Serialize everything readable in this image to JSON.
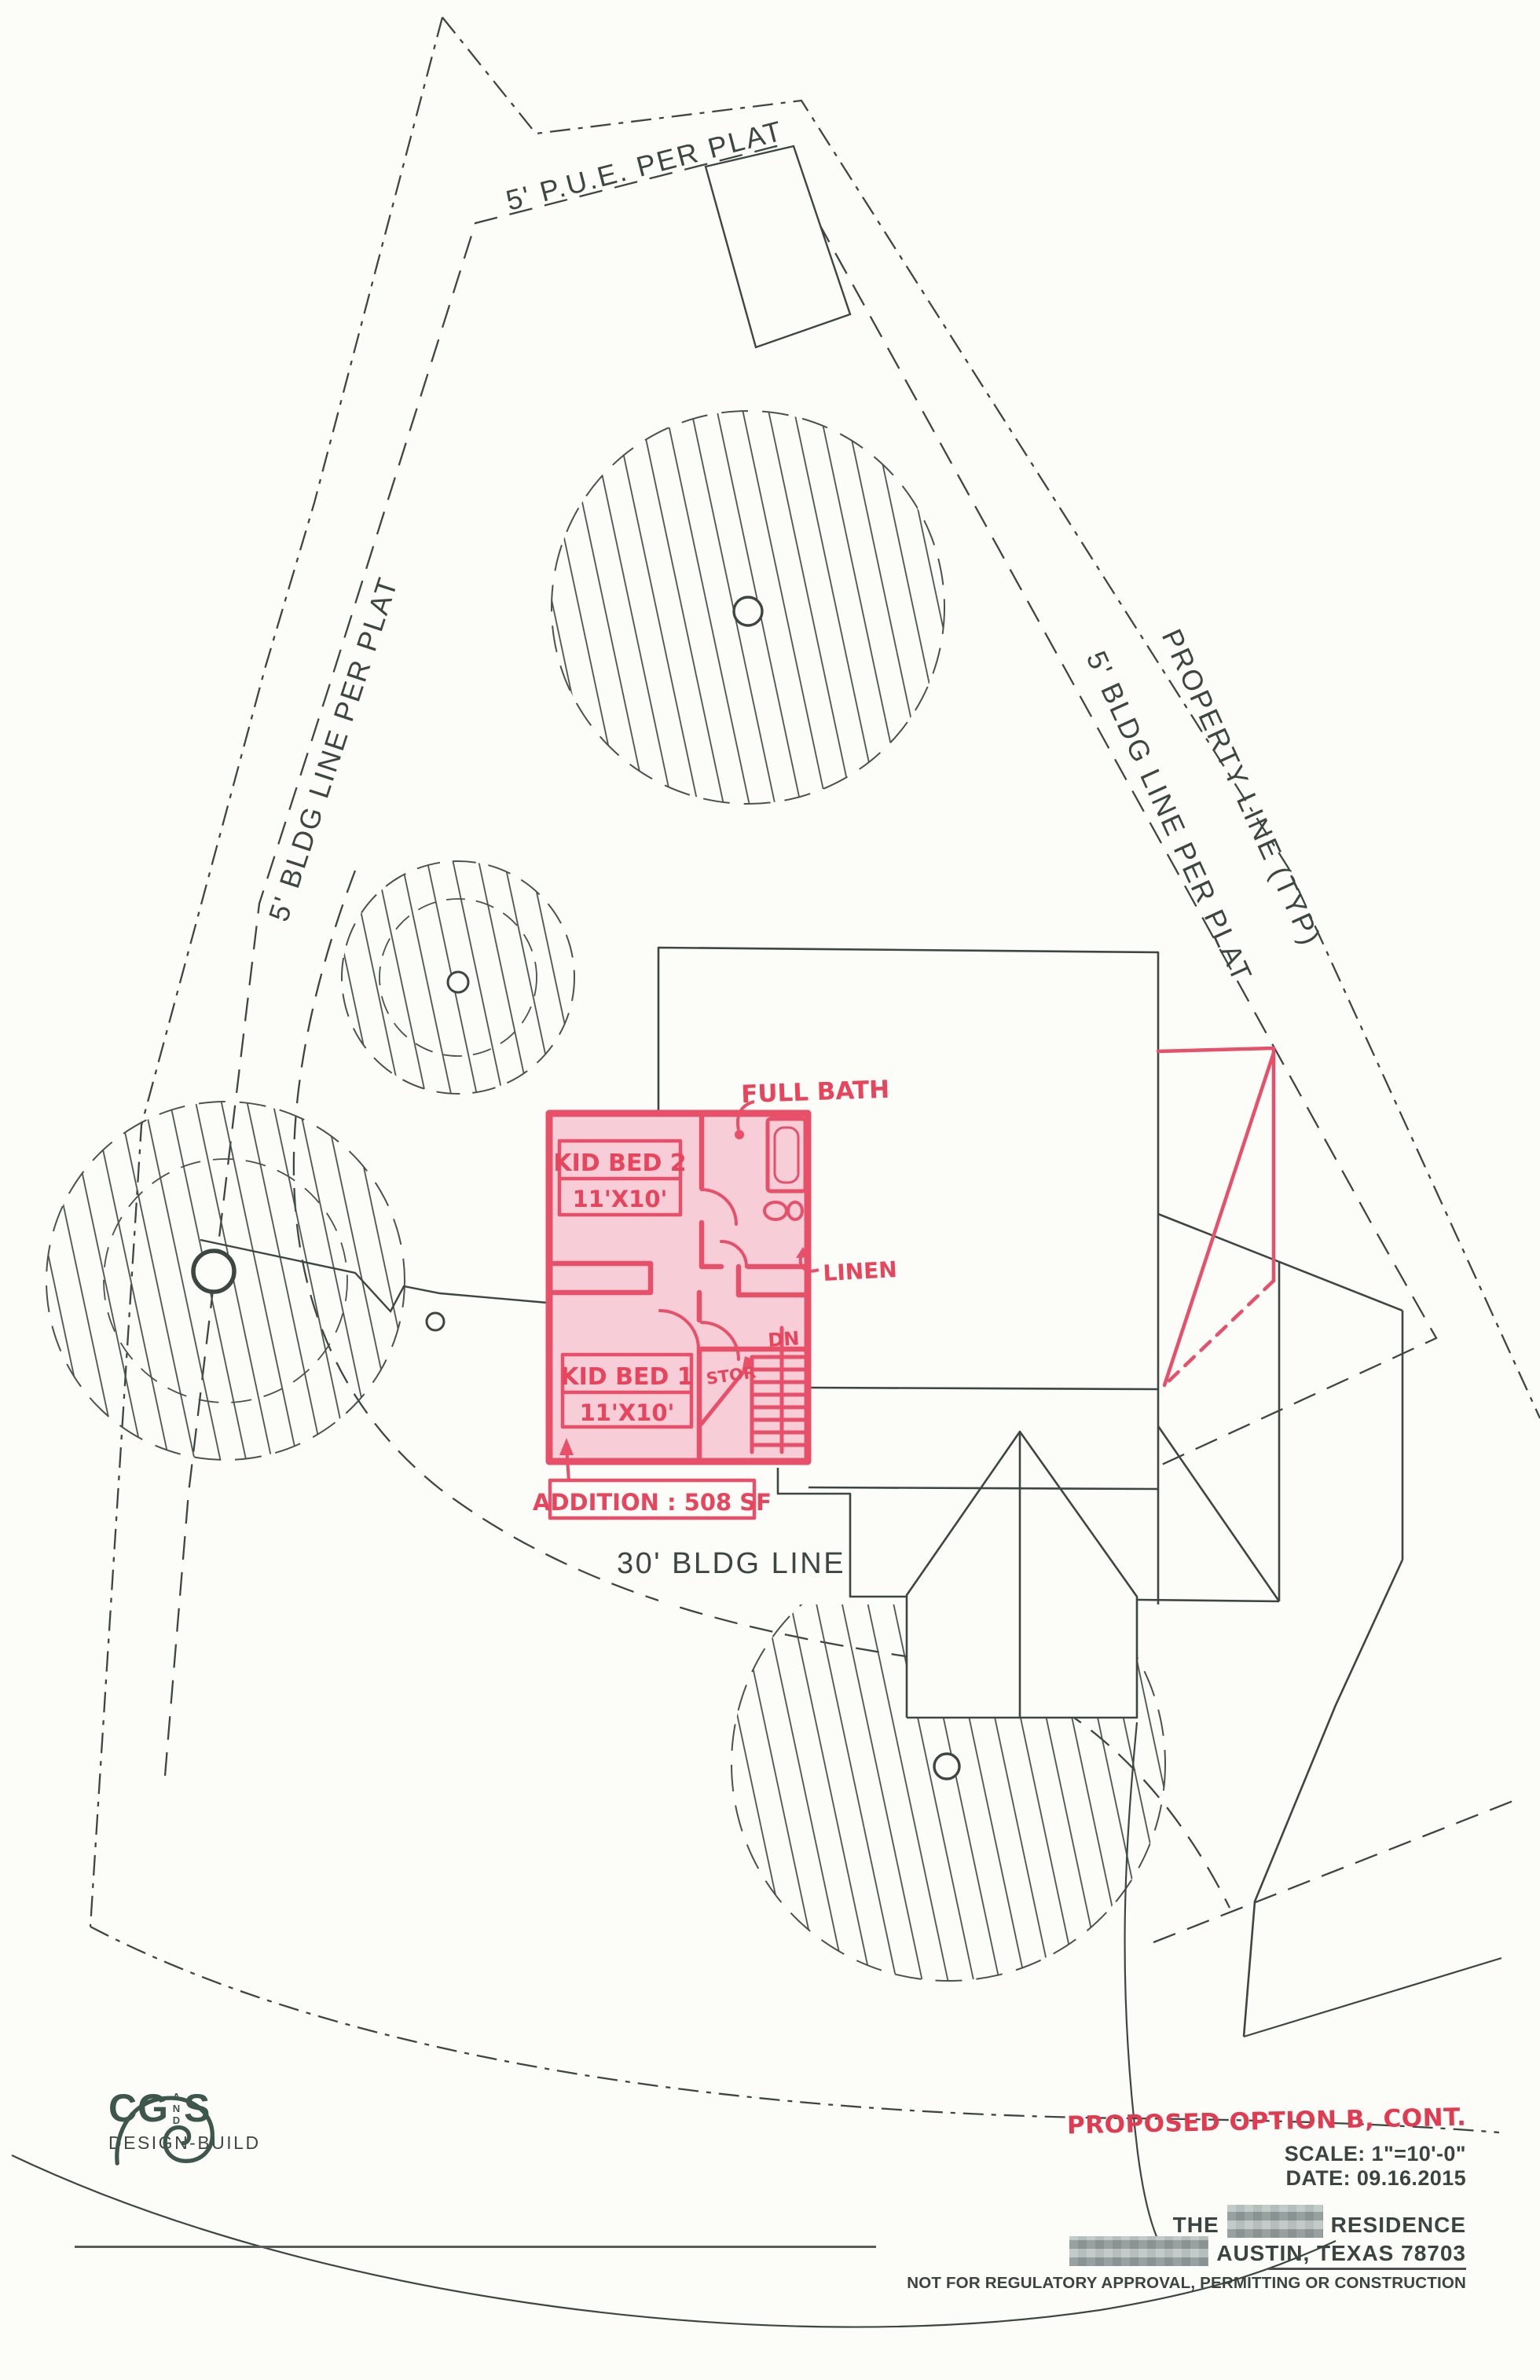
{
  "colors": {
    "ink": "#3d4742",
    "red_marker": "#e8506a",
    "red_text": "#e23a50",
    "pink_fill": "#f8d3dc",
    "logo_green": "#3e574d",
    "paper": "#fcfcf9"
  },
  "site": {
    "labels": {
      "pue": "5' P.U.E. PER PLAT",
      "bldg_left": "5' BLDG LINE PER PLAT",
      "property_line": "PROPERTY LINE (TYP)",
      "bldg_right": "5' BLDG LINE PER PLAT",
      "bldg_30": "30' BLDG LINE"
    }
  },
  "plan": {
    "room2": {
      "name": "KID BED 2",
      "size": "11'X10'"
    },
    "room1": {
      "name": "KID BED 1",
      "size": "11'X10'"
    },
    "bath_label": "FULL BATH",
    "linen_label": "LINEN",
    "stor_label": "STOR",
    "stair_label": "DN",
    "addition_note": "ADDITION : 508 SF"
  },
  "title_block": {
    "option_note": "PROPOSED OPTION B, CONT.",
    "scale": "SCALE: 1\"=10'-0\"",
    "date": "DATE: 09.16.2015",
    "residence_prefix": "THE",
    "residence_suffix": "RESIDENCE",
    "city": "AUSTIN, TEXAS 78703",
    "disclaimer": "NOT FOR REGULATORY APPROVAL, PERMITTING OR CONSTRUCTION"
  },
  "logo": {
    "cg": "CG",
    "and": "AND",
    "s": "S",
    "tagline": "DESIGN-BUILD"
  }
}
